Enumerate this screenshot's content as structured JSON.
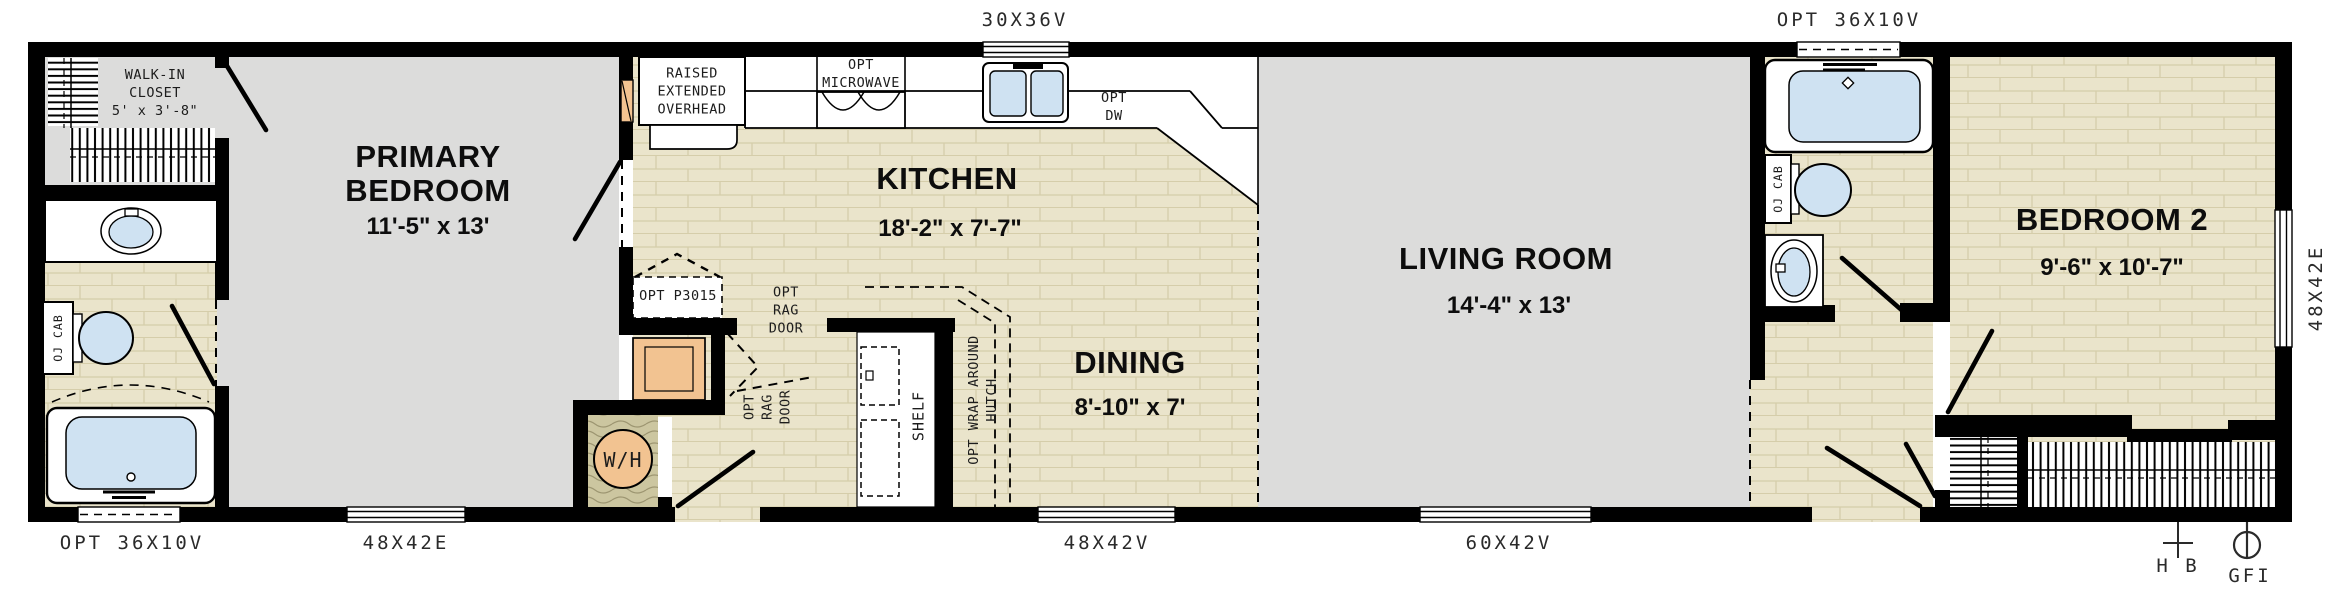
{
  "rooms": {
    "walk_in_closet": {
      "name": "WALK-IN\nCLOSET",
      "dims": "5' x 3'-8\""
    },
    "primary_bedroom": {
      "name": "PRIMARY\nBEDROOM",
      "dims": "11'-5\" x 13'"
    },
    "kitchen": {
      "name": "KITCHEN",
      "dims": "18'-2\" x 7'-7\""
    },
    "dining": {
      "name": "DINING",
      "dims": "8'-10\" x 7'"
    },
    "living_room": {
      "name": "LIVING ROOM",
      "dims": "14'-4\" x 13'"
    },
    "bedroom_2": {
      "name": "BEDROOM 2",
      "dims": "9'-6\" x 10'-7\""
    }
  },
  "windows": {
    "kitchen_top": "30X36V",
    "bath2_top": "OPT 36X10V",
    "bath1_bottom": "OPT 36X10V",
    "primary_bottom": "48X42E",
    "dining_bottom": "48X42V",
    "living_bottom": "60X42V",
    "bedroom2_side": "48X42E"
  },
  "annotations": {
    "raised_overhead": "RAISED\nEXTENDED\nOVERHEAD",
    "opt_microwave": "OPT\nMICROWAVE",
    "opt_dw": "OPT\nDW",
    "opt_p3015": "OPT P3015",
    "opt_rag_door_h": "OPT\nRAG\nDOOR",
    "opt_rag_door_v": "OPT\nRAG\nDOOR",
    "shelf": "SHELF",
    "wrap_hutch": "OPT WRAP AROUND\nHUTCH",
    "cab_bath1": "OJ CAB",
    "cab_bath2": "OJ CAB",
    "water_heater": "W/H",
    "hose_bib": "H B",
    "gfi": "GFI"
  },
  "colors": {
    "wall": "#000000",
    "floor_wood": "#eae4cb",
    "floor_wood_line": "#d5cdaa",
    "carpet": "#dcdcdb",
    "fixture_blue": "#cfe2f2",
    "cabinet_orange": "#f2c391",
    "wood_grain": "#ccc6a0",
    "outside": "#ffffff"
  }
}
